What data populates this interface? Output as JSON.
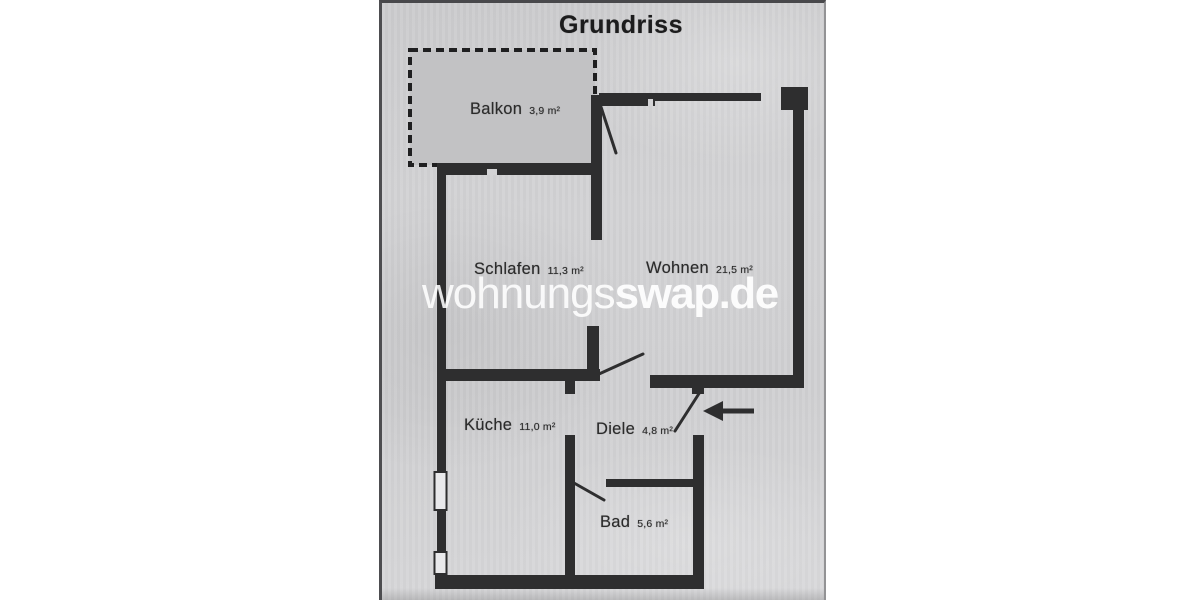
{
  "title": "Grundriss",
  "watermark": {
    "light": "wohnungs",
    "bold": "swap.de"
  },
  "rooms": [
    {
      "id": "balkon",
      "name": "Balkon",
      "area": "3,9 m²"
    },
    {
      "id": "schlafen",
      "name": "Schlafen",
      "area": "11,3 m²"
    },
    {
      "id": "wohnen",
      "name": "Wohnen",
      "area": "21,5 m²"
    },
    {
      "id": "kueche",
      "name": "Küche",
      "area": "11,0 m²"
    },
    {
      "id": "diele",
      "name": "Diele",
      "area": "4,8 m²"
    },
    {
      "id": "bad",
      "name": "Bad",
      "area": "5,6 m²"
    }
  ],
  "colors": {
    "paper": "#d3d3d5",
    "wall": "#2e2e2f",
    "ink": "#2b2b2b",
    "balcony": "#c2c2c4",
    "window-fill": "#e9e9eb",
    "watermark": "rgba(255,255,255,0.92)"
  }
}
